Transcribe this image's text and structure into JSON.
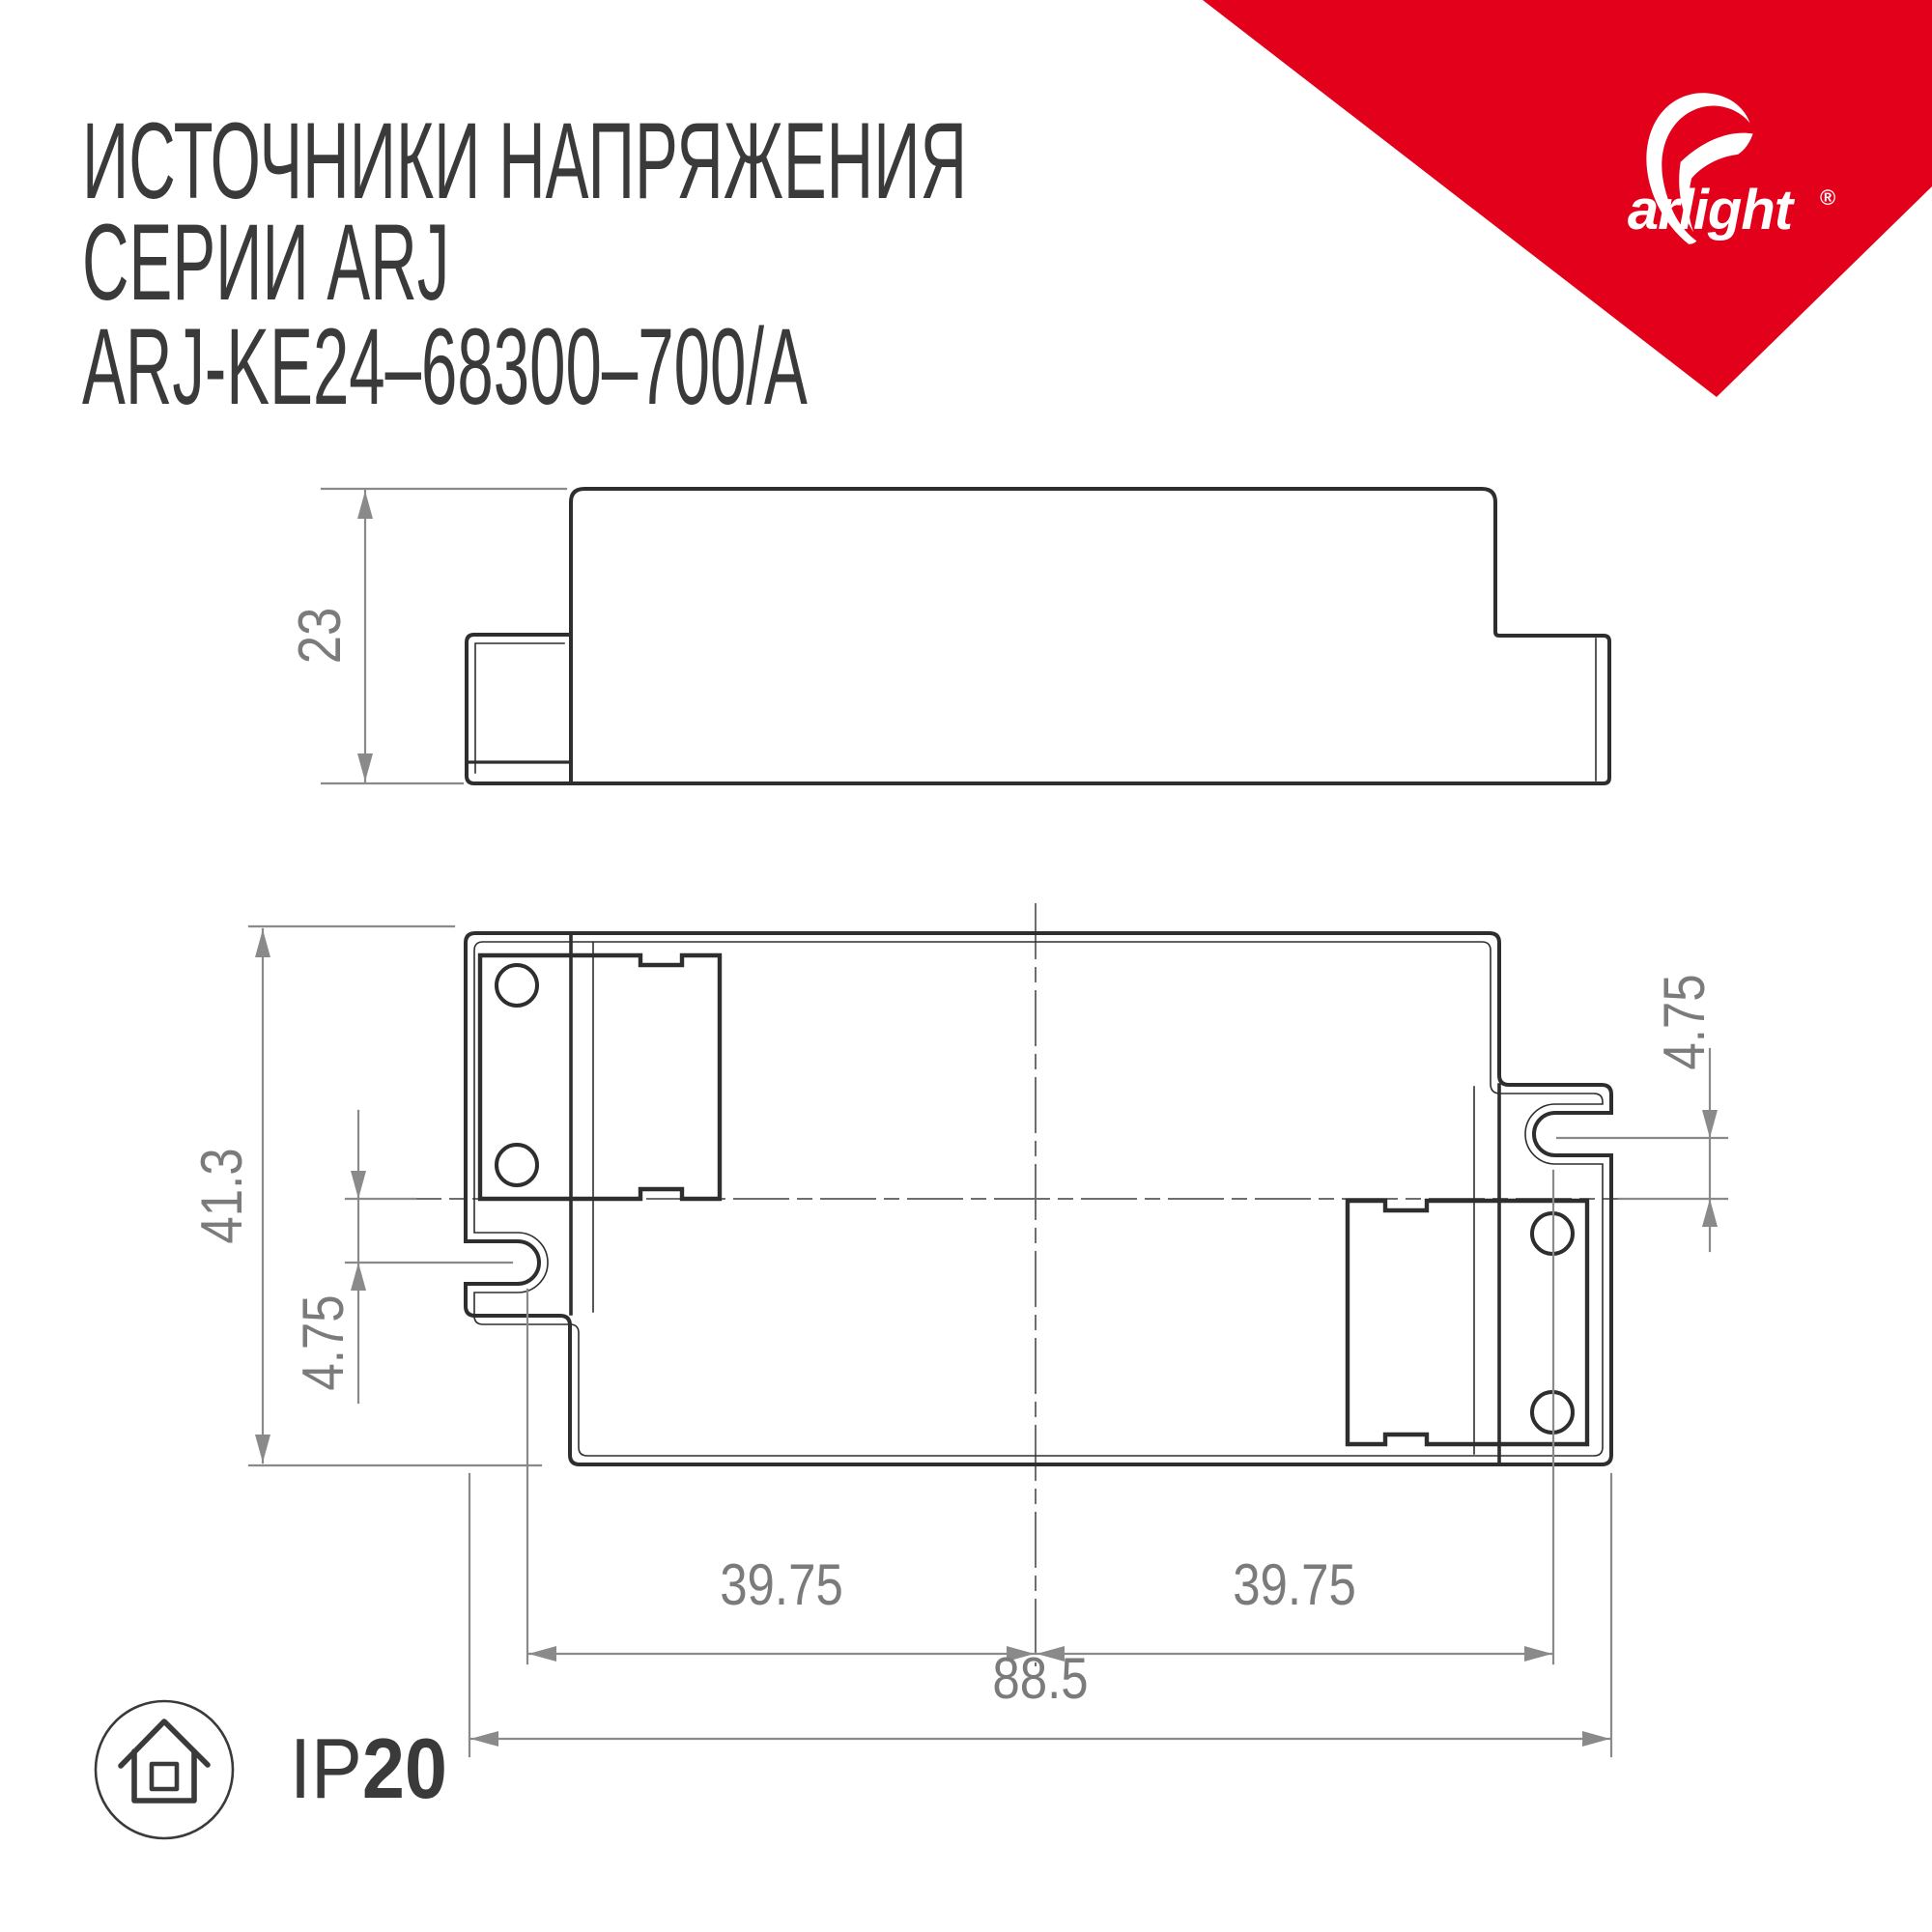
{
  "title": {
    "line1": "ИСТОЧНИКИ НАПРЯЖЕНИЯ",
    "line2": "СЕРИИ ARJ",
    "line3": "ARJ-KE24–68300–700/A"
  },
  "brand": {
    "name": "arlight",
    "registered_mark": "®",
    "accent_color": "#e2001a"
  },
  "side_view": {
    "height": "23"
  },
  "top_view": {
    "overall_height": "41.3",
    "overall_width": "88.5",
    "slot_offset_left": "4.75",
    "slot_offset_right": "4.75",
    "slot_span_left": "39.75",
    "slot_span_right": "39.75"
  },
  "footer": {
    "ip_prefix": "IP",
    "ip_value": "20"
  }
}
